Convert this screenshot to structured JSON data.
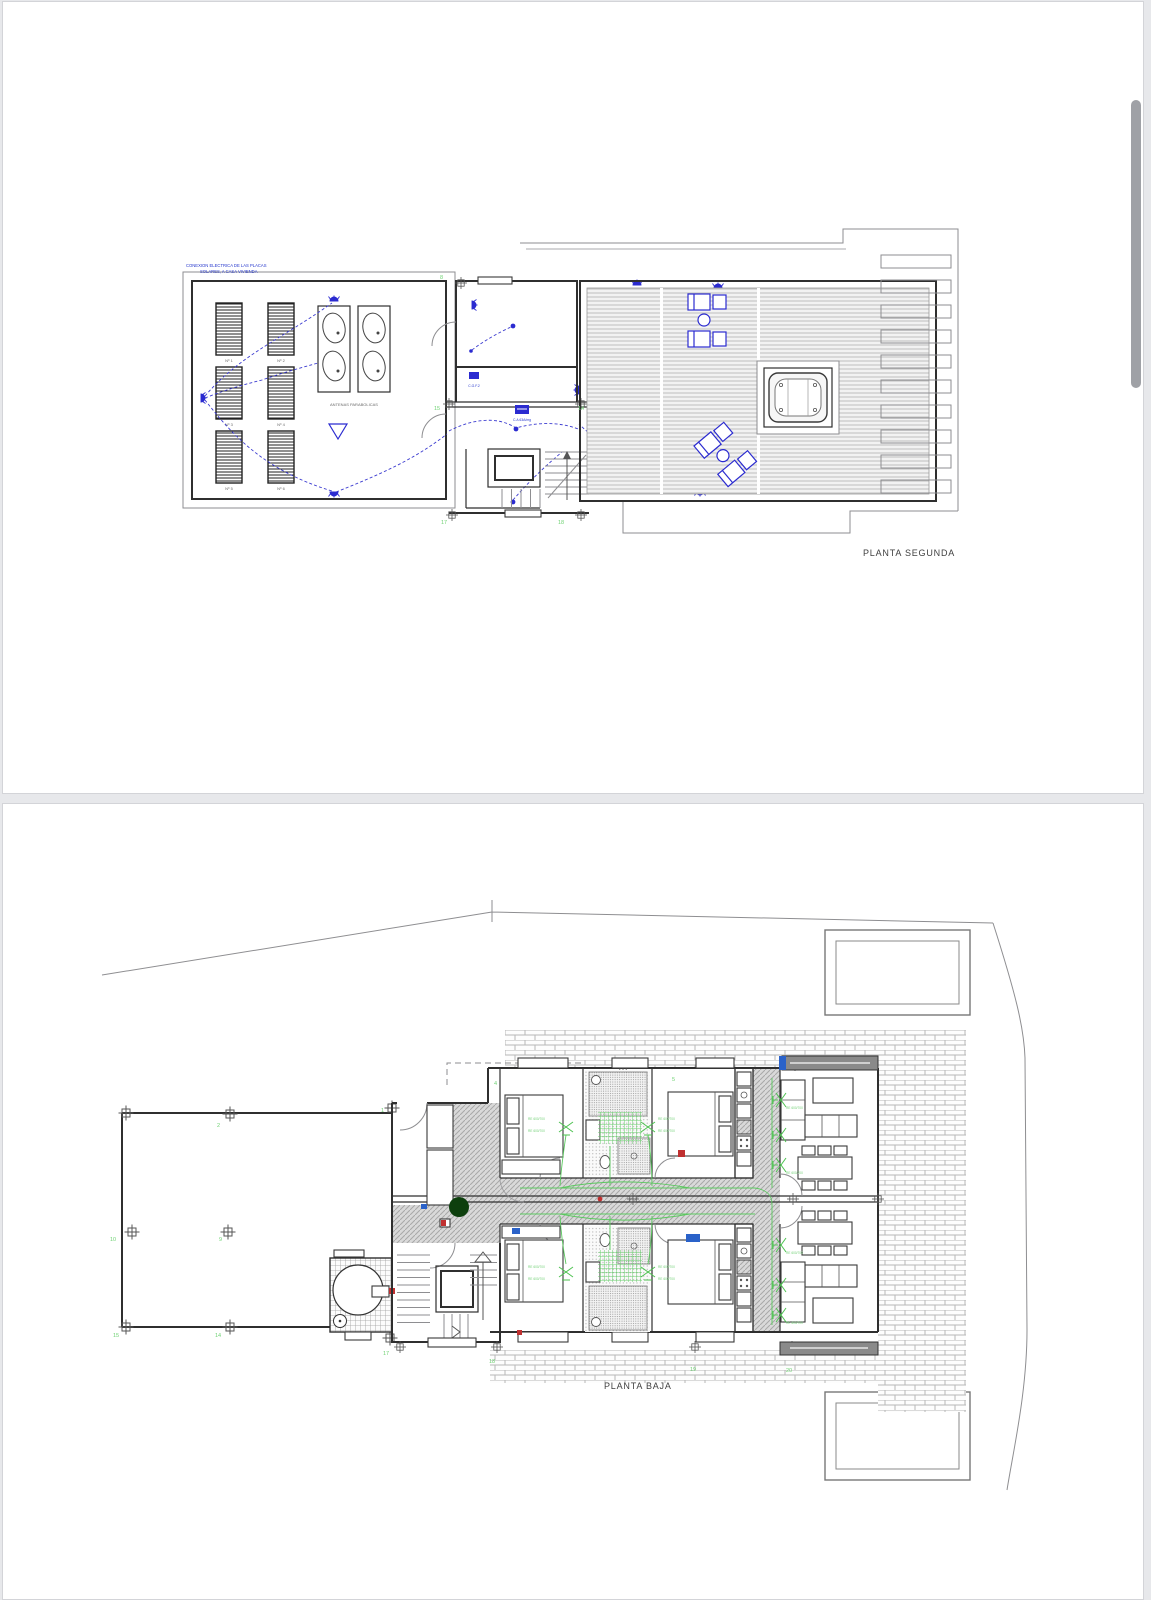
{
  "plan_segunda": {
    "title": "PLANTA SEGUNDA",
    "note": {
      "line1": "CONEXION ELECTRICA DE LAS PLACAS",
      "line2": "SOLARES, A CASA VIVIENDA"
    },
    "antennas_label": "ANTENAS PARABOLICAS",
    "solar_panels": [
      "Nº 1",
      "Nº 2",
      "Nº 3",
      "Nº 4",
      "Nº 5",
      "Nº 6"
    ],
    "electrical": {
      "cgf": "C.G.F.2",
      "ca": "C.A 63A/mg"
    },
    "junctions": [
      "8",
      "15",
      "14",
      "17",
      "18"
    ]
  },
  "plan_baja": {
    "title": "PLANTA BAJA",
    "re_label": "RE 600/700",
    "junctions": [
      "1",
      "2",
      "10",
      "9",
      "15",
      "14",
      "4",
      "5",
      "17",
      "18",
      "19",
      "20"
    ]
  },
  "colors": {
    "wiring_blue": "#2b2bd0",
    "wiring_green": "#5bc95f",
    "junction_green": "#6fd273",
    "wall_dark": "#2f2f2f",
    "page_white": "#ffffff",
    "canvas_gray": "#e7e8eb",
    "scrollbar_gray": "#9fa1a6",
    "accent_red": "#c03030",
    "tree_green": "#0d3f0d"
  }
}
